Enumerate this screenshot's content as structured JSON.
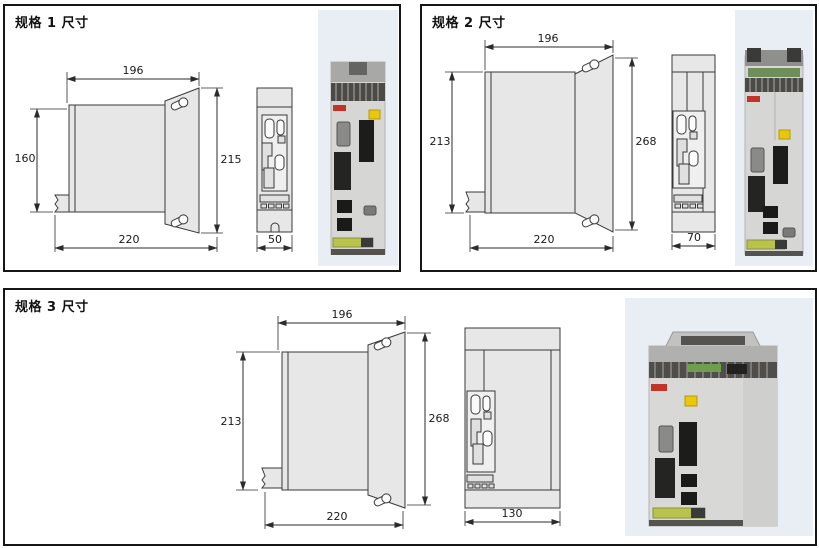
{
  "panels": [
    {
      "title": "规格 1 尺寸",
      "dims": {
        "top_width": "196",
        "left_height": "160",
        "right_height": "215",
        "bottom_width": "220",
        "front_width": "50"
      }
    },
    {
      "title": "规格 2 尺寸",
      "dims": {
        "top_width": "196",
        "left_height": "213",
        "right_height": "268",
        "bottom_width": "220",
        "front_width": "70"
      }
    },
    {
      "title": "规格 3 尺寸",
      "dims": {
        "top_width": "196",
        "left_height": "213",
        "right_height": "268",
        "bottom_width": "220",
        "front_width": "130"
      }
    }
  ],
  "colors": {
    "panel_border": "#161616",
    "drawing_fill": "#e7e7e7",
    "drawing_outline": "#3a3a3a",
    "photo_background": "#e9eef4",
    "drive_body": "#d6d6d4",
    "label_red": "#c23328",
    "sticker_yellow": "#e9c70c",
    "strip_green": "#b9c24c"
  }
}
